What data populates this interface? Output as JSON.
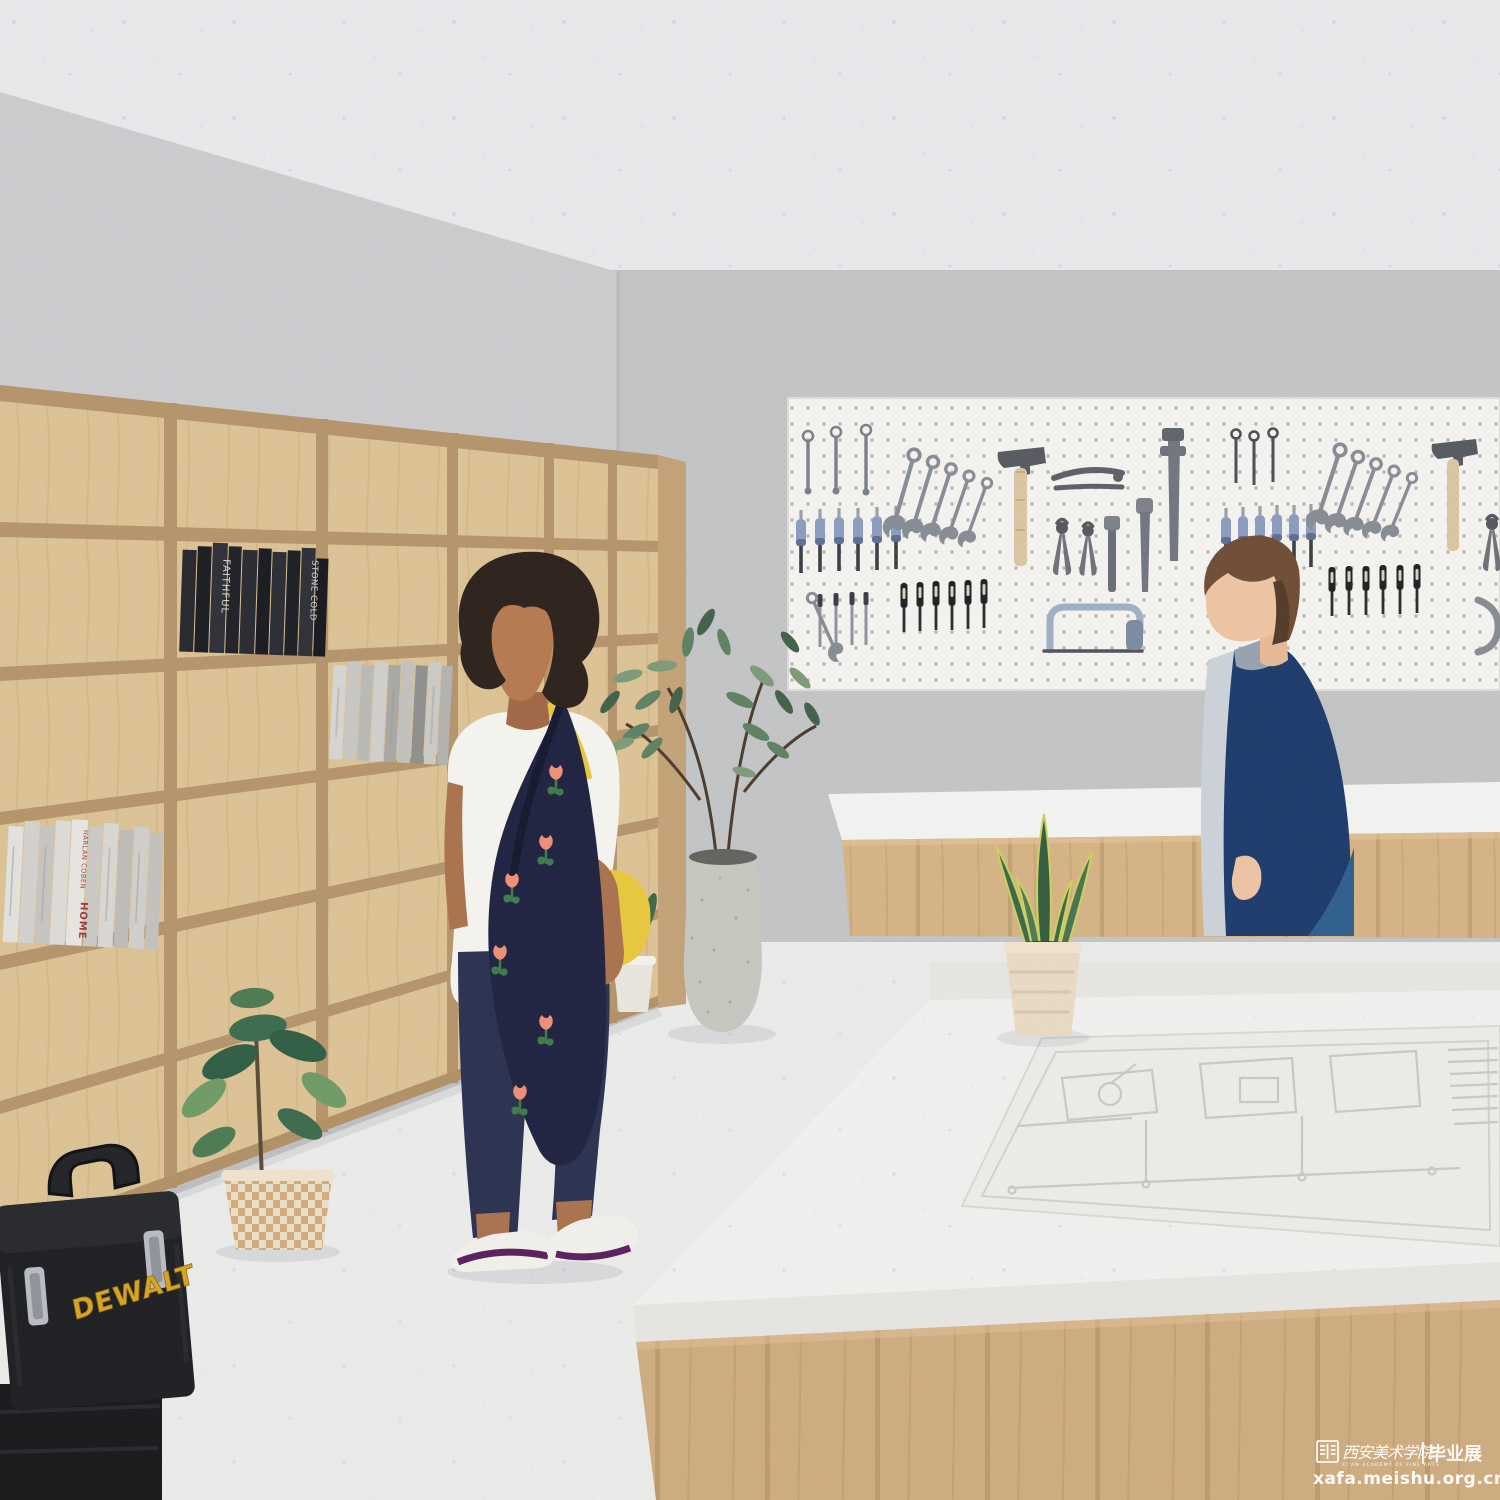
{
  "bookshelf": {
    "black_books": {
      "titles": [
        "FAITHFUL",
        "STONE COLD"
      ]
    },
    "white_books": {
      "author": "HARLAN COBEN",
      "title": "HOME"
    }
  },
  "toolbox": {
    "brand": "DEWALT"
  },
  "watermark": {
    "academy_cn": "西安美术学院",
    "academy_en": "XI'AN ACADEMY OF FINE ARTS",
    "exhibition_cn": "毕业展",
    "url": "xafa.meishu.org.cn"
  },
  "palette": {
    "ceiling": "#e8e8ea",
    "wall": "#c6c7c9",
    "shelf_wood": "#dcc395",
    "counter_wood": "#d5b384",
    "pegboard": "#f4f3f0",
    "workbench_top": "#f1f0ee",
    "navy_jacket": "#1c3a6b",
    "navy_pants": "#2a3150",
    "toolbox_yellow": "#d8a41f",
    "plant_green": "#3c6b4f"
  }
}
